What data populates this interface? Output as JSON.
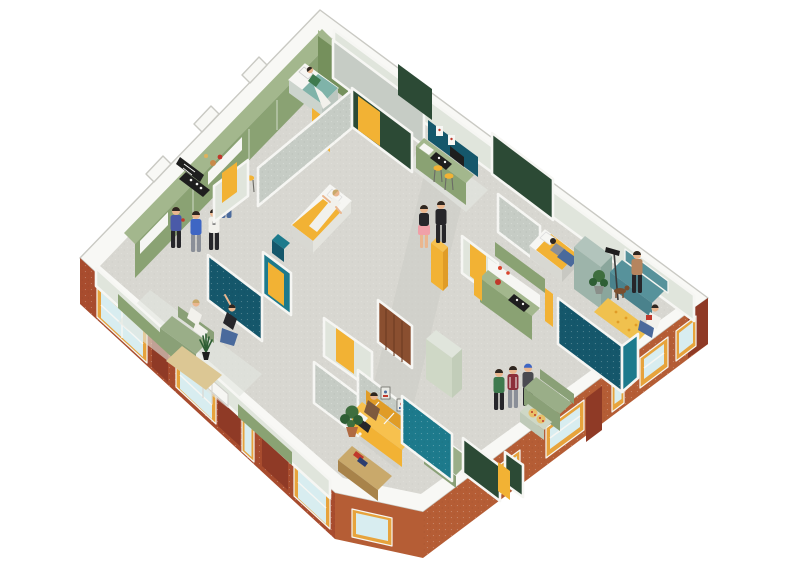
{
  "scene": {
    "title": "Isometric cutaway floor plan of a shared co-living apartment",
    "label": "Axonometric illustration of one apartment floor, cut open from above, with brick exterior walls, windows, furnished rooms and residents",
    "rooms": [
      {
        "id": "shared-kitchen-north",
        "label": "shared kitchen corridor with green cabinet wall"
      },
      {
        "id": "bedroom-north",
        "label": "bedroom with teal-blanket bed"
      },
      {
        "id": "kitchen-northeast",
        "label": "kitchen with teal backsplash and bar stools"
      },
      {
        "id": "bedroom-center",
        "label": "bedroom with yellow bed"
      },
      {
        "id": "bathroom-west",
        "label": "teal tiled bathroom with yellow door"
      },
      {
        "id": "hallway-center",
        "label": "central hallway"
      },
      {
        "id": "bedroom-east",
        "label": "bedroom with yellow bed and wardrobe"
      },
      {
        "id": "living-east",
        "label": "living corner with teal daybed and yellow rug"
      },
      {
        "id": "kitchenette-east",
        "label": "kitchenette with sage cabinets"
      },
      {
        "id": "bathroom-east",
        "label": "teal tiled bathroom"
      },
      {
        "id": "living-south",
        "label": "living room with yellow sofa and gallery wall"
      },
      {
        "id": "bathroom-south",
        "label": "teal tiled bathroom partition"
      },
      {
        "id": "lounge-southeast",
        "label": "lounge with green sofa and snack table"
      },
      {
        "id": "lounge-southwest",
        "label": "lounge with green sofa and plant rug"
      }
    ],
    "people": [
      {
        "id": "man-blue-sweater",
        "label": "man in blue sweater holding red cup, shared kitchen"
      },
      {
        "id": "man-blue-tshirt",
        "label": "man in blue t-shirt, shared kitchen"
      },
      {
        "id": "man-white-tshirt",
        "label": "man in white graphic t-shirt, shared kitchen"
      },
      {
        "id": "cook-striped-top",
        "label": "person in striped top cooking at counter"
      },
      {
        "id": "sleeper-north",
        "label": "person resting on teal bed"
      },
      {
        "id": "sleeper-center",
        "label": "person in white lying on yellow bed"
      },
      {
        "id": "sleeper-east",
        "label": "person lying face down on yellow bed"
      },
      {
        "id": "woman-pink-skirt",
        "label": "woman in pink skirt walking in hallway"
      },
      {
        "id": "man-black-outfit",
        "label": "man in black walking in hallway"
      },
      {
        "id": "man-brown-sweater",
        "label": "man seated on yellow sofa"
      },
      {
        "id": "woman-green-top",
        "label": "woman in green top, southeast lounge"
      },
      {
        "id": "man-maroon-jersey",
        "label": "man in maroon jersey, southeast lounge"
      },
      {
        "id": "man-blue-beanie",
        "label": "man in beanie, southeast lounge"
      },
      {
        "id": "woman-white-outfit",
        "label": "woman in white seated on green sofa"
      },
      {
        "id": "woman-stretching",
        "label": "woman stretching, southwest lounge"
      },
      {
        "id": "woman-standing-east",
        "label": "woman standing by teal daybed"
      },
      {
        "id": "woman-reading-floor",
        "label": "woman reading red book on floor"
      },
      {
        "id": "dog-east",
        "label": "small dog in east living corner"
      }
    ],
    "fixtures": [
      {
        "id": "exterior-windows",
        "label": "yellow-framed windows in brick facade",
        "count": 10
      },
      {
        "id": "yellow-doors",
        "label": "yellow interior doors",
        "count": 7
      },
      {
        "id": "beds",
        "label": "beds",
        "count": 4
      },
      {
        "id": "sofas",
        "label": "sofas and daybeds",
        "count": 4
      },
      {
        "id": "stoves",
        "label": "black cooktops",
        "count": 3
      },
      {
        "id": "plants",
        "label": "potted plants",
        "count": 4
      },
      {
        "id": "rugs",
        "label": "rugs",
        "count": 3
      }
    ]
  },
  "palette": {
    "band": "#f8f8f5",
    "band-stroke": "#c9c9c3",
    "floor": "#d8d7d1",
    "floor-hall": "#cdcdc6",
    "floor-pale": "#e3e6df",
    "brick-dark": "#8f3a26",
    "brick-mid": "#a84c2e",
    "brick-light": "#b55d35",
    "frame": "#e7a33c",
    "glass": "#d8edf0",
    "white": "#f6f6f3",
    "sage-dark": "#75905c",
    "sage": "#8aa273",
    "sage-light": "#a3b78d",
    "sage-pale": "#cfd8c6",
    "wall-pale": "#e0e5dc",
    "wall-gray": "#c6ccc5",
    "green-dark": "#2c4a35",
    "teal": "#1d7a8c",
    "teal-deep": "#15576b",
    "teal-soft": "#7fb3a9",
    "yellow": "#f2b234",
    "yellow-deep": "#e09c27",
    "yellow-light": "#f7c14e",
    "wood": "#c9a96b",
    "wood-dark": "#a8834a",
    "plank": "#8a4f30",
    "plank-dark": "#6e3c22",
    "ink": "#1e1e1e",
    "mist": "#9db4aa",
    "mist-light": "#b2c4bc",
    "mist-dark": "#8aa69c",
    "sofa-green": "#9aae88",
    "sofa-green-dark": "#8aa077",
    "sofa-teal": "#57929b",
    "sofa-teal-dark": "#4a828c",
    "rug-tan": "#dcc794",
    "rug-yellow": "#f0c14e",
    "plant": "#3e6e3e",
    "plant-dark": "#2e5e34",
    "terra": "#b06a42",
    "red": "#c0392b",
    "skin": "#eab68e",
    "hair": "#2e2620",
    "blonde": "#c9a96b",
    "c-navy": "#4a5aa8",
    "c-blue": "#3e66c4",
    "c-white": "#f2f1ec",
    "c-black": "#26262a",
    "c-gray": "#8a8f98",
    "c-maroon": "#8c2f3a",
    "c-green": "#3e7a4e",
    "c-pink": "#f0a0a8",
    "c-denim": "#4a6a9c",
    "c-brown": "#7e5a3e",
    "c-tan": "#b5855f",
    "c-stripe": "#e87a6a"
  }
}
